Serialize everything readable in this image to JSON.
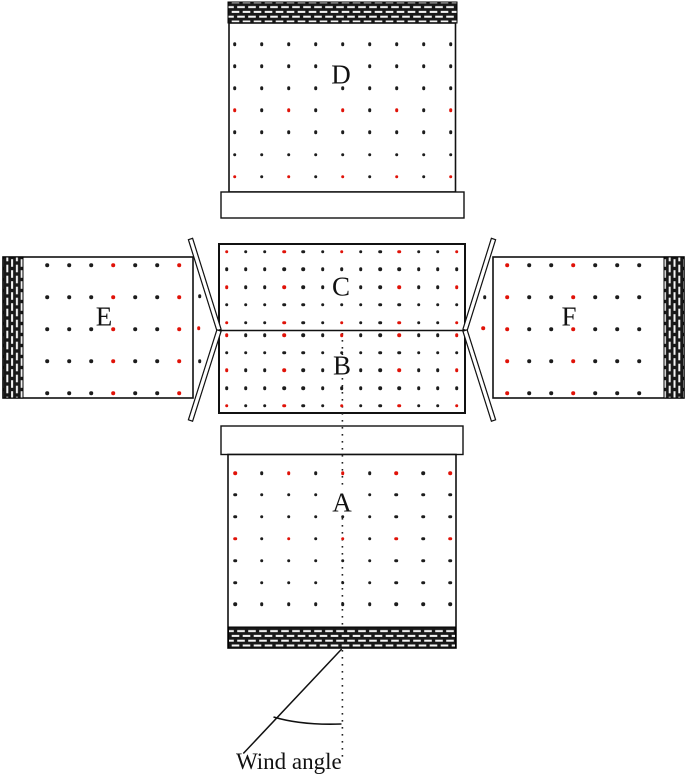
{
  "figure": {
    "annotation": "Wind angle",
    "colors": {
      "tap_black": "#1c1c1c",
      "tap_red": "#e01208"
    }
  },
  "panels": {
    "A": {
      "label": "A",
      "grid": {
        "cols": 9,
        "rows": 7,
        "x0": 235,
        "y0": 473,
        "dx": 26.9,
        "dy": 21.9
      },
      "red_cells": [
        [
          1,
          1
        ],
        [
          1,
          3
        ],
        [
          1,
          5
        ],
        [
          1,
          7
        ],
        [
          1,
          9
        ],
        [
          4,
          1
        ],
        [
          4,
          3
        ],
        [
          4,
          5
        ],
        [
          4,
          7
        ],
        [
          4,
          9
        ]
      ],
      "skip_cells": [
        [
          2,
          5
        ]
      ]
    },
    "B": {
      "label": "B",
      "grid": {
        "cols": 13,
        "rows": 5,
        "x0": 226.5,
        "y0": 335,
        "dx": 19.2,
        "dy": 17.7
      },
      "red_cells": [
        [
          1,
          1
        ],
        [
          1,
          4
        ],
        [
          1,
          7
        ],
        [
          1,
          10
        ],
        [
          1,
          13
        ],
        [
          3,
          1
        ],
        [
          3,
          4
        ],
        [
          3,
          10
        ],
        [
          3,
          13
        ],
        [
          5,
          1
        ],
        [
          5,
          4
        ],
        [
          5,
          7
        ],
        [
          5,
          10
        ],
        [
          5,
          13
        ]
      ],
      "skip_cells": [
        [
          3,
          7
        ]
      ]
    },
    "C": {
      "label": "C",
      "grid": {
        "cols": 13,
        "rows": 5,
        "x0": 226.5,
        "y0": 251.5,
        "dx": 19.2,
        "dy": 17.8
      },
      "red_cells": [
        [
          1,
          1
        ],
        [
          1,
          4
        ],
        [
          1,
          7
        ],
        [
          1,
          10
        ],
        [
          1,
          13
        ],
        [
          3,
          1
        ],
        [
          3,
          4
        ],
        [
          3,
          10
        ],
        [
          3,
          13
        ],
        [
          5,
          1
        ],
        [
          5,
          4
        ],
        [
          5,
          7
        ],
        [
          5,
          10
        ],
        [
          5,
          13
        ]
      ],
      "skip_cells": [
        [
          3,
          7
        ]
      ]
    },
    "D": {
      "label": "D",
      "grid": {
        "cols": 9,
        "rows": 7,
        "x0": 234.5,
        "y0": 44,
        "dx": 27,
        "dy": 22.1
      },
      "red_cells": [
        [
          4,
          1
        ],
        [
          4,
          3
        ],
        [
          4,
          5
        ],
        [
          4,
          7
        ],
        [
          4,
          9
        ],
        [
          7,
          1
        ],
        [
          7,
          3
        ],
        [
          7,
          5
        ],
        [
          7,
          7
        ],
        [
          7,
          9
        ]
      ],
      "skip_cells": [
        [
          2,
          5
        ]
      ]
    },
    "E": {
      "label": "E",
      "grid": {
        "cols": 7,
        "rows": 5,
        "x0": 47,
        "y0": 265,
        "dx": 22,
        "dy": 32
      },
      "red_cells": [
        [
          1,
          4
        ],
        [
          1,
          7
        ],
        [
          2,
          4
        ],
        [
          2,
          7
        ],
        [
          3,
          4
        ],
        [
          3,
          7
        ],
        [
          4,
          4
        ],
        [
          4,
          7
        ],
        [
          5,
          4
        ],
        [
          5,
          7
        ]
      ],
      "skip_cells": []
    },
    "F": {
      "label": "F",
      "grid": {
        "cols": 7,
        "rows": 5,
        "x0": 507,
        "y0": 265,
        "dx": 22,
        "dy": 32
      },
      "red_cells": [
        [
          1,
          1
        ],
        [
          1,
          4
        ],
        [
          2,
          1
        ],
        [
          2,
          4
        ],
        [
          3,
          1
        ],
        [
          3,
          4
        ],
        [
          4,
          1
        ],
        [
          4,
          4
        ],
        [
          5,
          1
        ],
        [
          5,
          4
        ]
      ],
      "skip_cells": []
    }
  },
  "extra_taps": [
    {
      "x": 199.5,
      "y": 296,
      "color": "black"
    },
    {
      "x": 198.5,
      "y": 328,
      "color": "red"
    },
    {
      "x": 199.5,
      "y": 361,
      "color": "black"
    },
    {
      "x": 484.5,
      "y": 297,
      "color": "black"
    },
    {
      "x": 483,
      "y": 328,
      "color": "red"
    }
  ]
}
